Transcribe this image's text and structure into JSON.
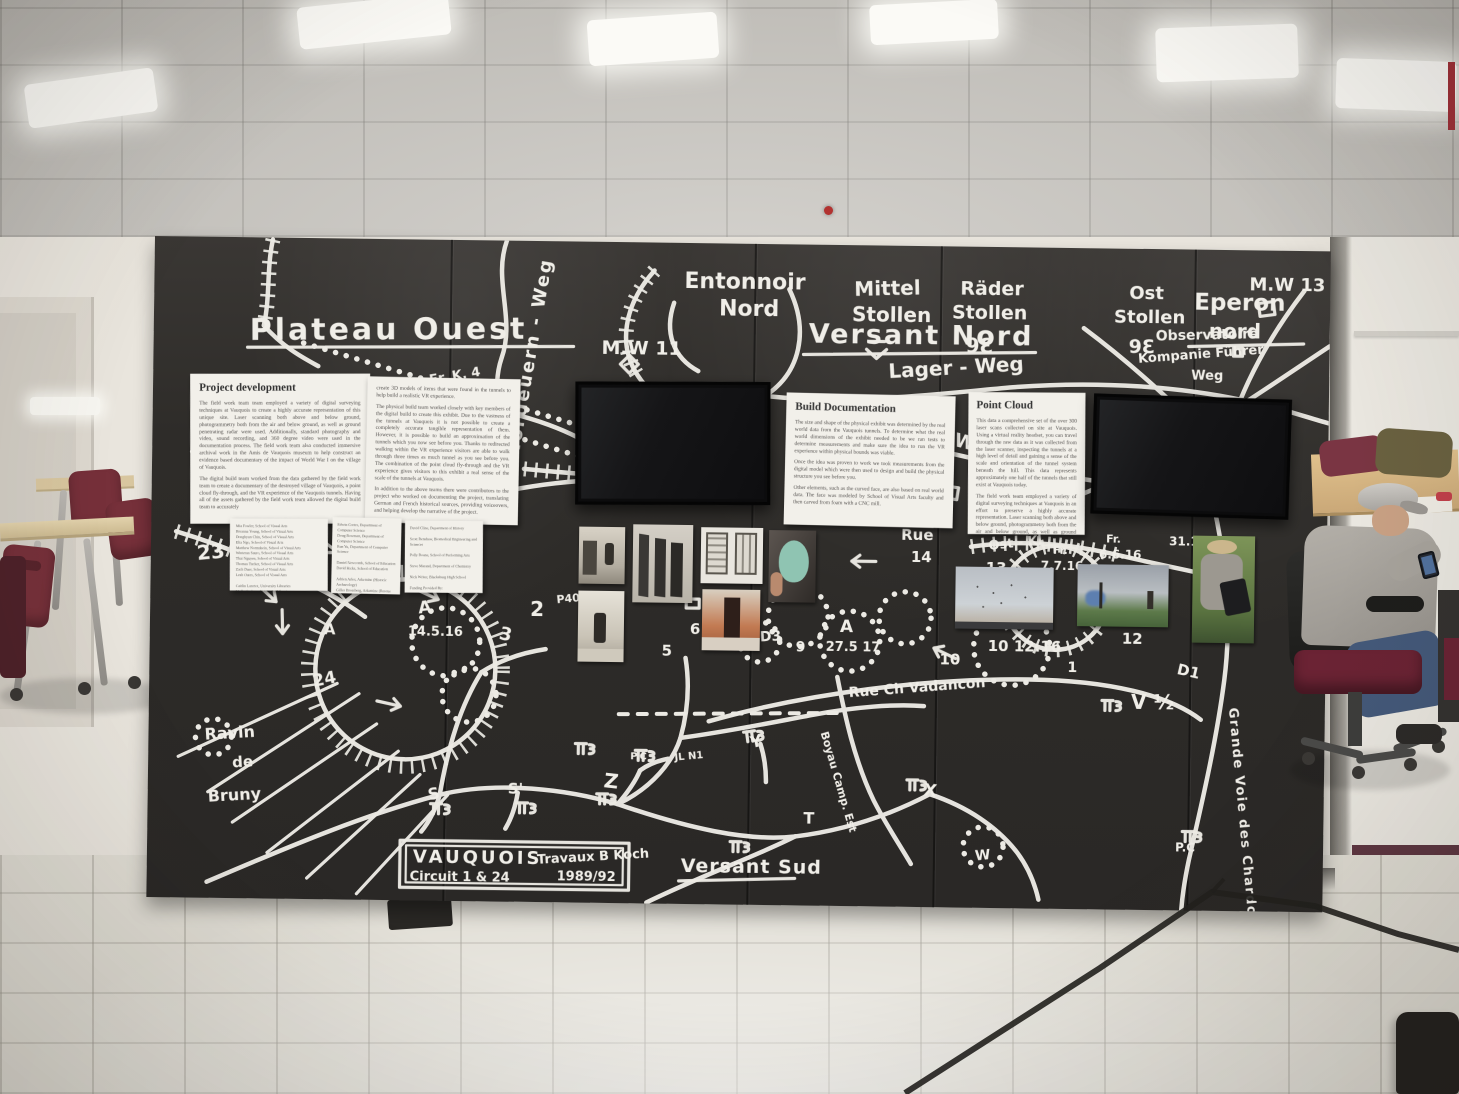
{
  "palette": {
    "wall_black": "#2e2c29",
    "chalk_white": "#eceae4",
    "chair_maroon": "#6b2334",
    "table_wood": "#d9ba84",
    "paper": "#f2f0ea"
  },
  "exhibit": {
    "map_labels": {
      "plateau_ouest": "Plateau Ouest",
      "nordgraben_weg": "Nordeuern - Weg",
      "entonnoir_1": "Entonnoir",
      "entonnoir_2": "Nord",
      "mw11": "M.W 11",
      "mittel_1": "Mittel",
      "mittel_2": "Stollen",
      "rader_1": "Räder",
      "rader_2": "Stollen",
      "rader_mark": "9Ɛ",
      "ost_1": "Ost",
      "ost_2": "Stollen",
      "ost_mark": "9Ɛ",
      "versant_nord": "Versant Nord",
      "lager_weg": "Lager - Weg",
      "minenwerfer_weg": "Minenwerfer - Weg",
      "eperon_1": "Eperon",
      "eperon_2": "nord",
      "mw13": "M.W 13",
      "observatoire": "Observatoire",
      "kompanie_1": "Kompanie Führer",
      "kompanie_2": "Weg",
      "erk4": "Er. K. 4",
      "n19": "19",
      "n7r": "7r",
      "n15": "15",
      "rue": "Rue",
      "n14": "14",
      "ost_kl": "Ost - Kl",
      "n13": "13",
      "fr_a": "Fr.",
      "d7716": "7.7.16",
      "fr_b": "Fr.",
      "d6616": "6.6.16",
      "d3112": "31.12",
      "d101216": "10 12.16",
      "n12": "12",
      "n10": "10",
      "n1": "1",
      "d1": "D1",
      "v12": "V ½",
      "grande_voie": "Grande Voie des Chardon",
      "pc_right": "P.C",
      "a_mid": "A",
      "d27517": "27.5 17",
      "rue_ch": "Rue Ch Vadancon",
      "a_left": "A",
      "d14516": "14.5.16",
      "a_crater": "A",
      "n2": "2",
      "n3": "3",
      "p40": "P40",
      "n5": "5",
      "n6": "6",
      "d3": "D3",
      "n9": "9",
      "s1": "S",
      "s2": "S'",
      "z": "Z",
      "pc_mid": "P.C",
      "jl_n1": "JL N1",
      "y": "Y",
      "t": "T",
      "x": "X",
      "w": "W",
      "boyau": "Boyau Camp. Est",
      "n23": "23",
      "n24": "24",
      "ravin_1": "Ravin",
      "ravin_2": "de",
      "ravin_3": "Bruny",
      "versant_sud": "Versant Sud"
    },
    "sign": {
      "name": "VAUQUOIS",
      "circuit": "Circuit 1 & 24",
      "author": "Travaux B Koch",
      "years": "1989/92"
    },
    "panels": {
      "project": {
        "title": "Project development",
        "p1": "The field work team team employed a variety of digital surveying techniques at Vauquois to create a highly accurate representation of this unique site. Laser scanning both above and below ground, photogrammetry both from the air and below ground, as well as ground penetrating radar were used. Additionally, standard photography and video, sound recording, and 360 degree video were used in the documentation process. The field work team also conducted immersive archival work in the Amis de Vauquois museum to help construct an evidence based documentary of the impact of World War I on the village of Vauquois.",
        "p2": "The digital build team worked from the data gathered by the field work team to create a documentary of the destroyed village of Vauquois, a point cloud fly-through, and the VR experience of the Vauquois tunnels. Having all of the assets gathered by the field work team allowed the digital build team to accurately"
      },
      "continuation": {
        "p1": "create 3D models of items that were found in the tunnels to help build a realistic VR experience.",
        "p2": "The physical build team worked closely with key members of the digital build to create this exhibit. Due to the vastness of the tunnels at Vauquois it is not possible to create a completely accurate tangible representation of them. However, it is possible to build an approximation of the tunnels which you now see before you. Thanks to redirected walking within the VR experience visitors are able to walk through three times as much tunnel as you see before you. The combination of the point cloud fly-through and the VR experience gives visitors to this exhibit a real sense of the scale of the tunnels at Vauquois.",
        "p3": "In addition to the above teams there were contributors to the project who worked on documenting the project, translating German and French historical sources, providing voiceovers, and helping develop the narrative of the project."
      },
      "build": {
        "title": "Build Documentation",
        "p1": "The size and shape of the physical exhibit was determined by the real world data from the Vauquois tunnels. To determine what the real world dimensions of the exhibit needed to be we ran tests to determine measurements and make sure the idea to run the VR experience within physical bounds was viable.",
        "p2": "Once the idea was proven to work we took measurements from the digital model which were then used to design and build the physical structure you see before you.",
        "p3": "Other elements, such as the curved face, are also based on real world data. The face was modeled by School of Visual Arts faculty and then carved from foam with a CNC mill."
      },
      "cloud": {
        "title": "Point Cloud",
        "p1": "This data a comprehensive set of the over 300 laser scans collected on site at Vauquois. Using a virtual reality headset, you can travel through the raw data as it was collected from the laser scanner, inspecting the tunnels at a high level of detail and gaining a sense of the scale and orientation of the tunnel system beneath the hill. This data represents approximately one half of the tunnels that still exist at Vauquois today.",
        "p2": "The field work team employed a variety of digital surveying techniques at Vauquois in an effort to preserve a highly accurate representation. Laser scanning both above and below ground, photogrammetry both from the air and below ground, as well as ground penetrating radar were used. Finally, standard photography and video, sound recording, and 360 degree video were captured to document this unique site."
      }
    },
    "credits": {
      "left": "Mia Fowler, School of Visual Arts\nBreanna Young, School of Visual Arts\nDonghyun Chin, School of Visual Arts\nElia Ngo, School of Visual Arts\nMatthew Normshein, School of Visual Arts\nWinteran Sauro, School of Visual Arts\nThai Nguyen, School of Visual Arts\nThomas Tucker, School of Visual Arts\nZach Duer, School of Visual Arts\nLeah Oates, School of Visual Arts\n\nCaitlin Lanctot, University Libraries\nMolly Graham, University Libraries\nScott Nolan, University Libraries\nTodd Ogle, University Libraries",
      "middle": "Edwin Cortes, Department of Computer Science\nDoug Bowman, Department of Computer Science\nRun Yu, Department of Computer Science\n\nDaniel Newcomb, School of Education\nDavid Hicks, School of Education\n\nAdrien Arles, Arkemine (Historic Archaeology)\nGilles Brossberg, Arkemine (Rescue Archaeology)\n\nYves Maucort, Amis de Vauquois (Amis de la VB of Vauquois)\n\nErik Westman, Department of Mining and Minerals Engineering",
      "right": "David Cline, Department of History\n\nScott Renshaw, Biomedical Engineering and Sciences\n\nPolly Roane, School of Performing Arts\n\nSteve Marand, Department of Chemistry\n\nNick Writer, Blacksburg High School\n\nFunding Provided By:\n\nThe Virginia Tech Institute for Creativity, Arts, and Technology\nUniversity Libraries"
    }
  }
}
